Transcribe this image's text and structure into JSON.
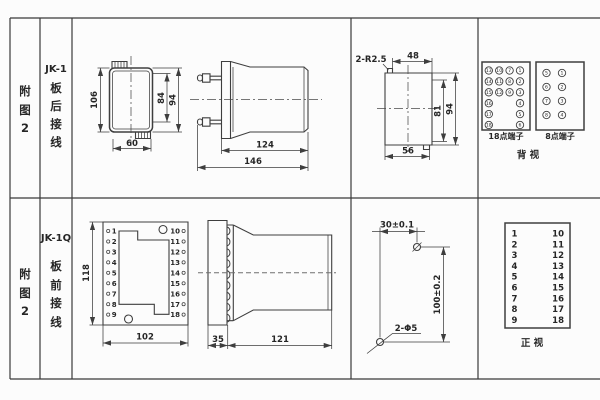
{
  "colors": {
    "line": "#3e3e3e",
    "text": "#262626",
    "bg": "#fcfcfc"
  },
  "sidebar": {
    "fig1": [
      "附",
      "图",
      "2"
    ],
    "fig2": [
      "附",
      "图",
      "2"
    ]
  },
  "row1": {
    "model": "JK-1",
    "wiring": [
      "板",
      "后",
      "接",
      "线"
    ],
    "front": {
      "h": "106",
      "inner_h": "84",
      "outer_h": "94",
      "w": "60"
    },
    "side": {
      "body_len": "124",
      "total_len": "146"
    },
    "cutout": {
      "note": "2-R2.5",
      "top_w": "48",
      "inner_h": "81",
      "outer_h": "94",
      "bottom_w": "56"
    },
    "term18": {
      "label": "18点端子",
      "rows": [
        [
          "13",
          "10",
          "7",
          "1"
        ],
        [
          "14",
          "11",
          "8",
          "2"
        ],
        [
          "15",
          "12",
          "9",
          "3"
        ],
        [
          "16",
          "4"
        ],
        [
          "17",
          "5"
        ],
        [
          "18",
          "6"
        ]
      ]
    },
    "term8": {
      "label": "8点端子",
      "rows": [
        [
          "5",
          "1"
        ],
        [
          "6",
          "2"
        ],
        [
          "7",
          "3"
        ],
        [
          "8",
          "4"
        ]
      ]
    },
    "view": "背  视"
  },
  "row2": {
    "model": "JK-1Q",
    "wiring": [
      "板",
      "前",
      "接",
      "线"
    ],
    "front": {
      "h": "118",
      "w": "102",
      "left": [
        "1",
        "2",
        "3",
        "4",
        "5",
        "6",
        "7",
        "8",
        "9"
      ],
      "right": [
        "10",
        "11",
        "12",
        "13",
        "14",
        "15",
        "16",
        "17",
        "18"
      ]
    },
    "side": {
      "flange": "35",
      "body_len": "121"
    },
    "drill": {
      "w": "30±0.1",
      "h": "100±0.2",
      "note": "2-Φ5"
    },
    "table": {
      "left": [
        "1",
        "2",
        "3",
        "4",
        "5",
        "6",
        "7",
        "8",
        "9"
      ],
      "right": [
        "10",
        "11",
        "12",
        "13",
        "14",
        "15",
        "16",
        "17",
        "18"
      ],
      "view": "正  视"
    }
  }
}
